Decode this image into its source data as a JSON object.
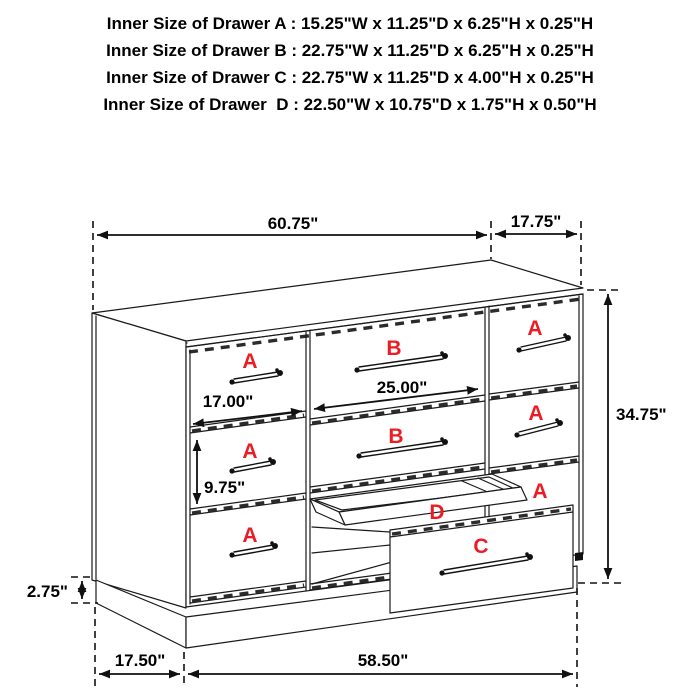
{
  "header": {
    "lines": [
      "Inner Size of Drawer A : 15.25\"W x 11.25\"D x 6.25\"H x 0.25\"H",
      "Inner Size of Drawer B : 22.75\"W x 11.25\"D x 6.25\"H x 0.25\"H",
      "Inner Size of Drawer C : 22.75\"W x 11.25\"D x 4.00\"H x 0.25\"H",
      "Inner Size of Drawer  D : 22.50\"W x 10.75\"D x 1.75\"H x 0.50\"H"
    ]
  },
  "dimensions": {
    "top_width": "60.75\"",
    "top_side_depth": "17.75\"",
    "overall_height": "34.75\"",
    "small_drawer_width": "17.00\"",
    "large_drawer_width": "25.00\"",
    "drawer_front_height": "9.75\"",
    "base_height": "2.75\"",
    "base_side_depth": "17.50\"",
    "base_width": "58.50\""
  },
  "drawer_labels": {
    "left_top": "A",
    "left_middle": "A",
    "left_bottom": "A",
    "middle_top": "B",
    "middle_middle": "B",
    "right_top": "A",
    "right_middle": "A",
    "right_bottom": "A",
    "tray": "D",
    "pulled_front": "C"
  },
  "colors": {
    "line": "#1a1a1a",
    "drawer_label": "#ec1c24",
    "dimension_text": "#000000",
    "background": "#ffffff"
  }
}
